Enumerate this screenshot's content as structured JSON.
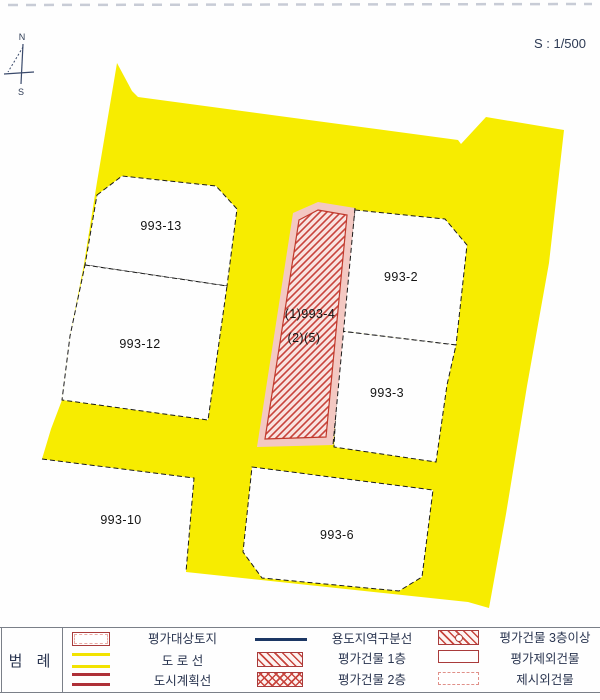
{
  "page": {
    "scale_label": "S : 1/500"
  },
  "compass": {
    "north": "N",
    "south": "S"
  },
  "map": {
    "parcels": [
      {
        "id": "993-13"
      },
      {
        "id": "993-12"
      },
      {
        "id": "993-2"
      },
      {
        "id": "993-3"
      },
      {
        "id": "993-6"
      },
      {
        "id": "993-10"
      }
    ],
    "target_parcel": {
      "line1": "(1)993-4",
      "line2": "(2)(5)"
    }
  },
  "legend": {
    "title": "범  례",
    "items": [
      {
        "label": "평가대상토지",
        "symbol": "target-parcel-box"
      },
      {
        "label": "도 로 선",
        "symbol": "road-lines-yellow"
      },
      {
        "label": "도시계획선",
        "symbol": "city-plan-lines-red"
      },
      {
        "label": "용도지역구분선",
        "symbol": "zoning-line-navy"
      },
      {
        "label": "평가건물 1층",
        "symbol": "hatch-diagonal"
      },
      {
        "label": "평가건물 2층",
        "symbol": "hatch-cross"
      },
      {
        "label": "평가건물 3층이상",
        "symbol": "hatch-diagonal-circle"
      },
      {
        "label": "평가제외건물",
        "symbol": "box-solid-red"
      },
      {
        "label": "제시외건물",
        "symbol": "box-dashed-pink"
      }
    ]
  },
  "colors": {
    "road_yellow": "#f7ec00",
    "target_band_pink": "#f3c8c2",
    "target_hatch_bg": "#f9e3e0",
    "target_hatch_red": "#c8443c",
    "zoning_navy": "#1c3764",
    "city_plan_red": "#ae3037",
    "legend_box_red": "#a93b3b"
  }
}
